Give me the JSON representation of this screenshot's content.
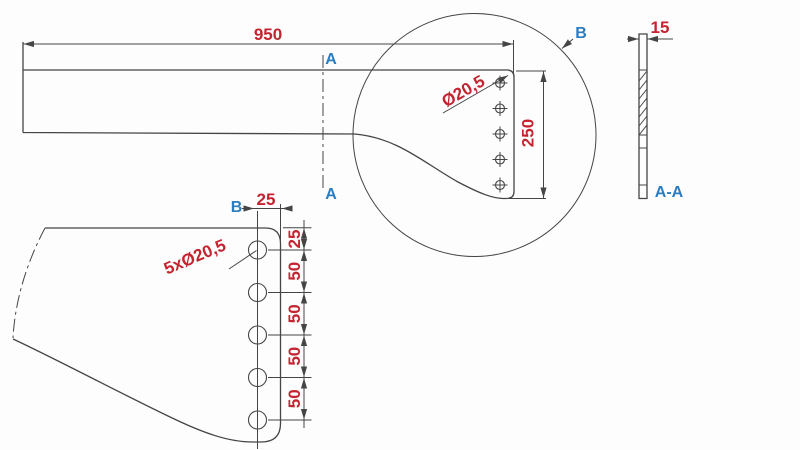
{
  "drawing": {
    "type": "engineering-drawing",
    "colors": {
      "dimension_red": "#c42430",
      "label_blue": "#2b7dc0",
      "line_dark": "#454545",
      "background": "#fdfdfd"
    },
    "front_view": {
      "length": "950",
      "section_top": "A",
      "section_bottom": "A"
    },
    "detail_circle": {
      "label": "B",
      "height": "250",
      "hole_diameter": "Ø20,5",
      "hole_count": 5
    },
    "side_view": {
      "thickness": "15",
      "section_name": "A-A"
    },
    "detail_view": {
      "label": "B",
      "edge_offset": "25",
      "holes_callout": "5xØ20,5",
      "hole_count": 5,
      "pitch_dims": [
        "25",
        "50",
        "50",
        "50",
        "50"
      ]
    }
  }
}
